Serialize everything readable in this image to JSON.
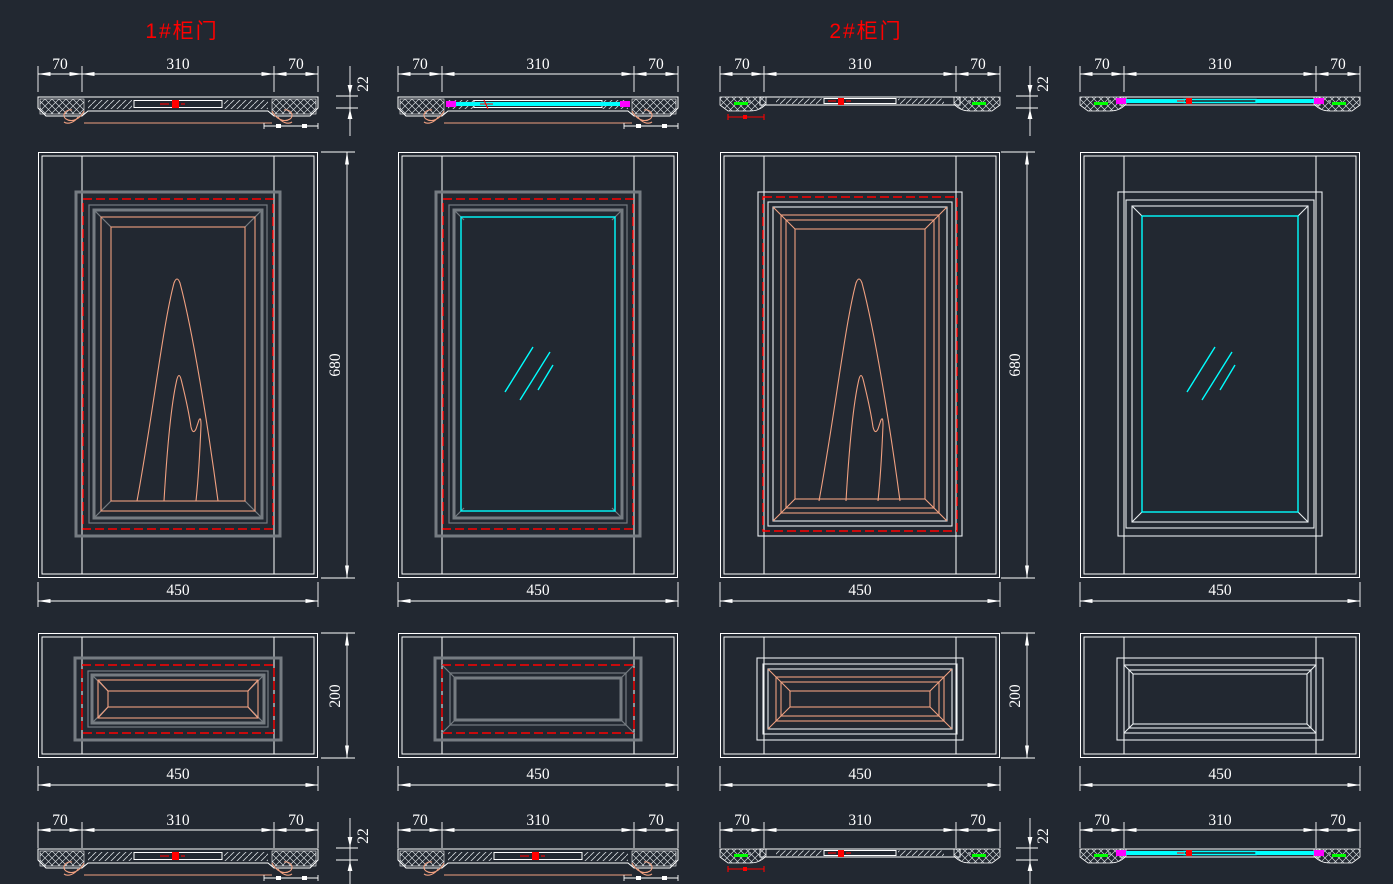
{
  "titles": {
    "door1": "1#柜门",
    "door2": "2#柜门"
  },
  "dimensions": {
    "stile": "70",
    "panel_opening": "310",
    "door_width": "450",
    "door_height": "680",
    "drawer_height": "200",
    "thickness": "22"
  },
  "colors": {
    "background": "#222831",
    "line_white": "#ffffff",
    "frame_gray": "#767c82",
    "accent_red": "#ff0000",
    "molding_salmon": "#f0a080",
    "glass_cyan": "#00ffff",
    "marker_magenta": "#ff00ff",
    "marker_green": "#00ff00"
  }
}
